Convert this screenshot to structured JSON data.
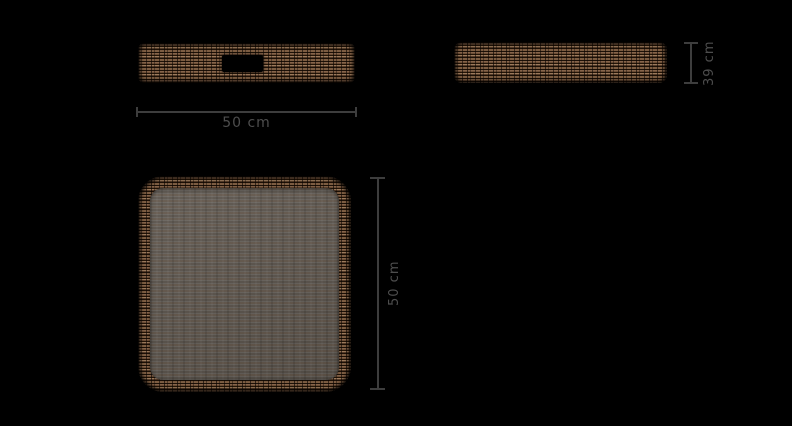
{
  "canvas": {
    "width": 792,
    "height": 426,
    "background": "#000000"
  },
  "product": {
    "type": "square-wicker-tray",
    "material": "wicker",
    "wicker_color_dark": "#241609",
    "wicker_color_mid": "#7a5a40",
    "wicker_color_light": "#9c7a5c",
    "surface_color": "#66615b"
  },
  "annotations": {
    "line_color": "#3d3d3d",
    "text_color": "#4d4d4d",
    "front_width_label": "50 cm",
    "side_height_label": "39 cm",
    "top_depth_label": "50 cm"
  }
}
